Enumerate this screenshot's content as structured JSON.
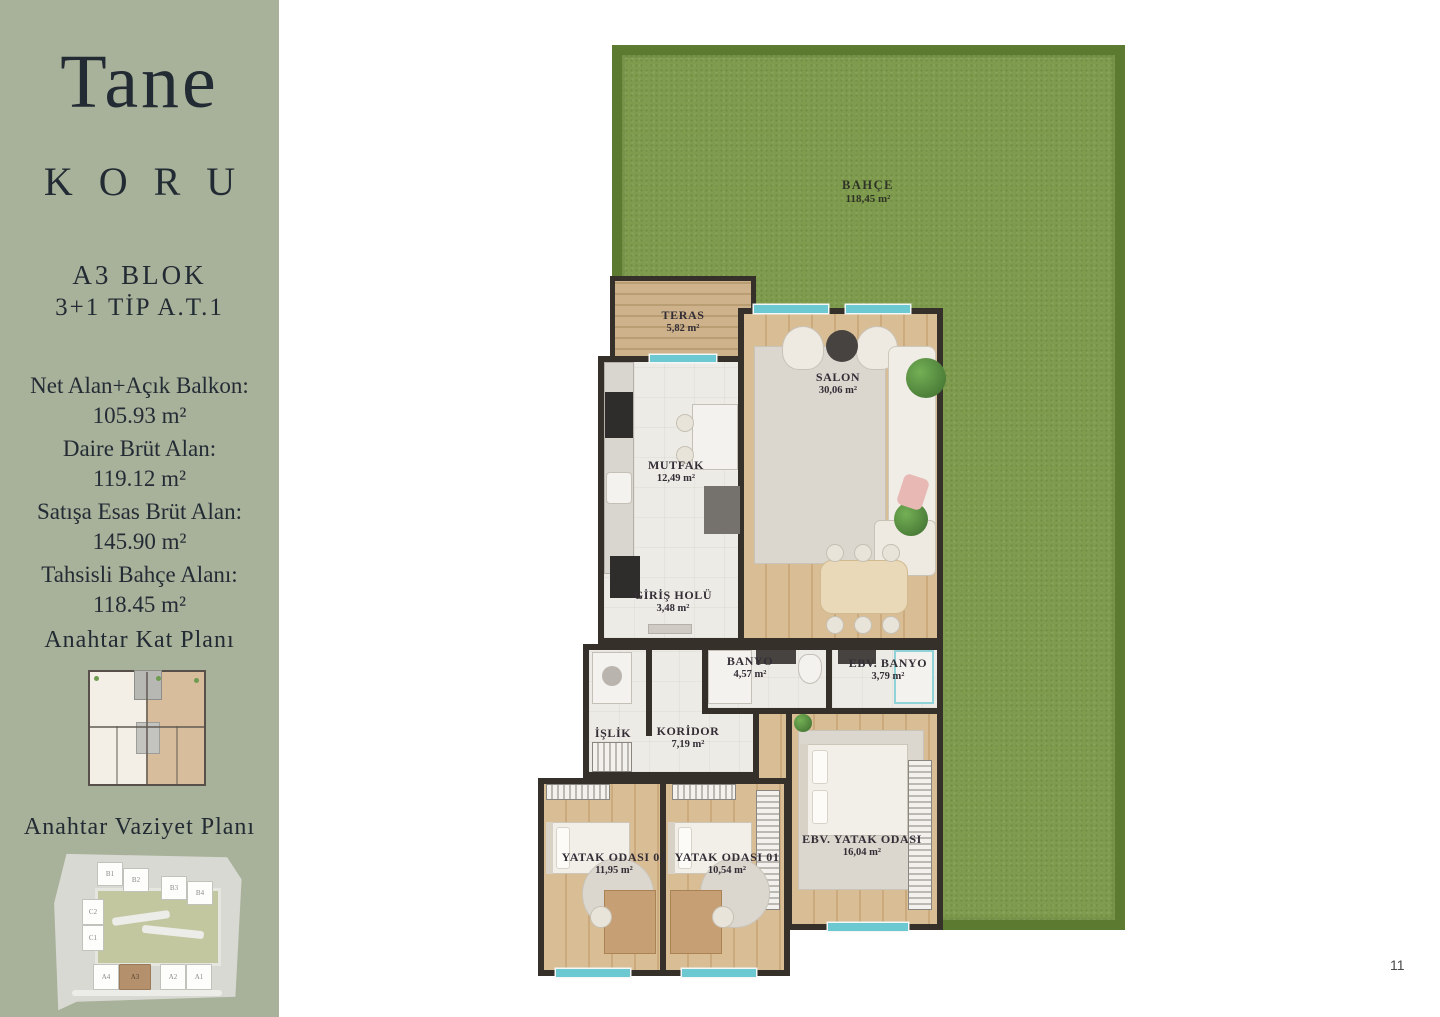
{
  "page": {
    "number": "11"
  },
  "sidebar": {
    "brand_line1": "Tane",
    "brand_line2": "KORU",
    "block_title": "A3 BLOK",
    "type_title": "3+1 TİP A.T.1",
    "areas": [
      {
        "label": "Net Alan+Açık Balkon:",
        "value": "105.93 m²"
      },
      {
        "label": "Daire Brüt Alan:",
        "value": "119.12 m²"
      },
      {
        "label": "Satışa Esas Brüt Alan:",
        "value": "145.90 m²"
      },
      {
        "label": "Tahsisli Bahçe Alanı:",
        "value": "118.45 m²"
      }
    ],
    "key_floor_plan_title": "Anahtar Kat Planı",
    "key_site_plan_title": "Anahtar Vaziyet Planı",
    "site_blocks": [
      "B1",
      "B2",
      "B3",
      "B4",
      "C2",
      "C1",
      "A4",
      "A3",
      "A2",
      "A1"
    ],
    "highlighted_block": "A3"
  },
  "floor_plan": {
    "garden": {
      "name": "BAHÇE",
      "area": "118,45 m²"
    },
    "rooms": [
      {
        "name": "TERAS",
        "area": "5,82 m²"
      },
      {
        "name": "SALON",
        "area": "30,06 m²"
      },
      {
        "name": "MUTFAK",
        "area": "12,49 m²"
      },
      {
        "name": "GİRİŞ HOLÜ",
        "area": "3,48 m²"
      },
      {
        "name": "BANYO",
        "area": "4,57 m²"
      },
      {
        "name": "EBV. BANYO",
        "area": "3,79 m²"
      },
      {
        "name": "İŞLİK",
        "area": ""
      },
      {
        "name": "KORİDOR",
        "area": "7,19 m²"
      },
      {
        "name": "YATAK ODASI 02",
        "area": "11,95 m²"
      },
      {
        "name": "YATAK ODASI 01",
        "area": "10,54 m²"
      },
      {
        "name": "EBV. YATAK ODASI",
        "area": "16,04 m²"
      }
    ]
  },
  "colors": {
    "sidebar_bg": "#a8b199",
    "text_dark": "#232c35",
    "garden_green": "#7f9c4e",
    "hedge_green": "#5d7a33",
    "wall_dark": "#36302a",
    "wood_floor": "#d9bd94",
    "window_teal": "#6cc8d1",
    "highlighted_block": "#b5906d"
  }
}
